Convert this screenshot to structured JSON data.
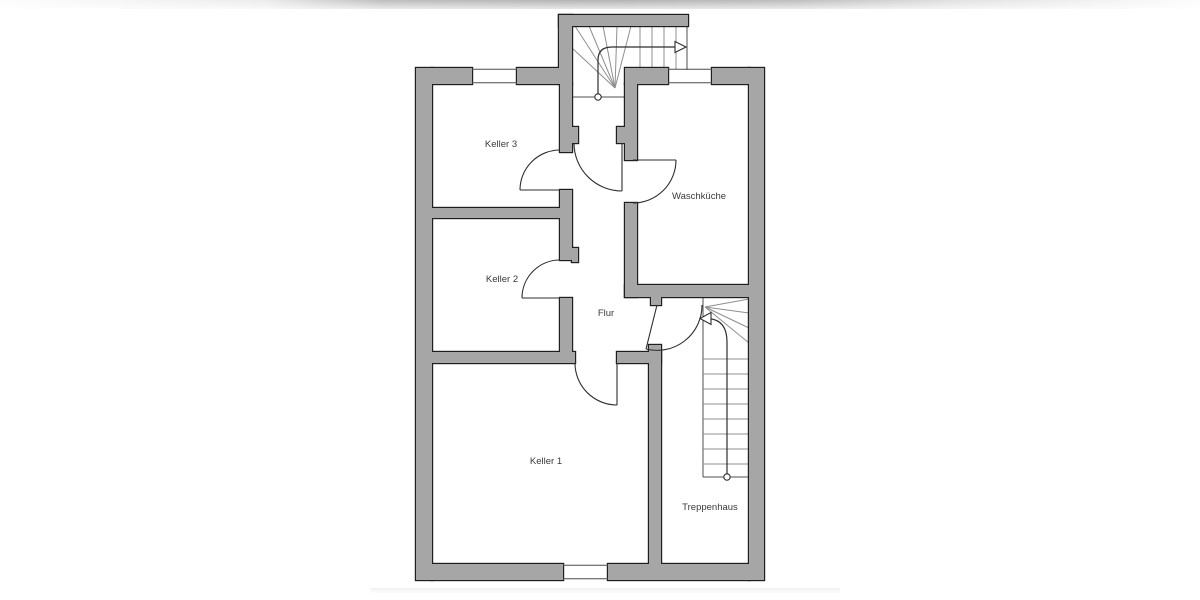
{
  "plan": {
    "type": "floor-plan",
    "rooms": [
      {
        "id": "keller3",
        "label": "Keller 3"
      },
      {
        "id": "keller2",
        "label": "Keller 2"
      },
      {
        "id": "keller1",
        "label": "Keller 1"
      },
      {
        "id": "waschkueche",
        "label": "Waschküche"
      },
      {
        "id": "flur",
        "label": "Flur"
      },
      {
        "id": "treppenhaus",
        "label": "Treppenhaus"
      }
    ]
  },
  "colors": {
    "wall-fill": "#a6a6a6",
    "wall-outline": "#1f1f1f",
    "line": "#4f4f4f",
    "line-dark": "#2e2e2e",
    "tread": "#8f8f8f",
    "label": "#3a3a3a",
    "top-band": "#b3b3b3",
    "background": "#ffffff"
  }
}
